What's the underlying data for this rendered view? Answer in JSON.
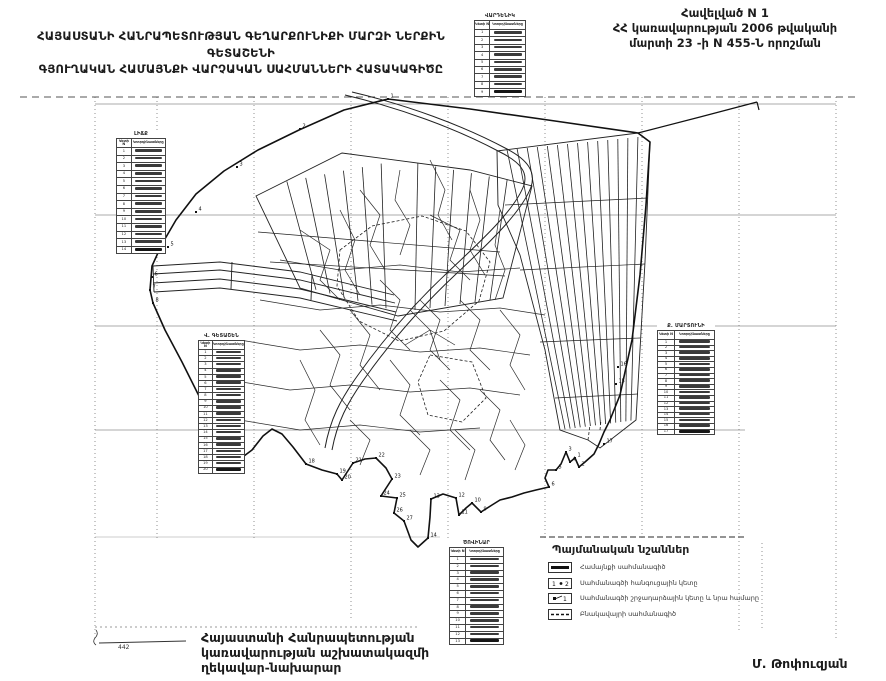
{
  "header": {
    "line1": "Հավելված N 1",
    "line2": "ՀՀ կառավարության 2006 թվականի",
    "line3": "մարտի 23 -ի N 455-Ն որոշման"
  },
  "title": {
    "line1": "ՀԱՅԱՍՏԱՆԻ ՀԱՆՐԱՊԵՏՈՒԹՅԱՆ ԳԵՂԱՐՔՈՒՆԻՔԻ ՄԱՐԶԻ ՆԵՐՔԻՆ ԳԵՏԱՇԵՆԻ",
    "line2": "ԳՅՈՒՂԱԿԱՆ ՀԱՄԱՅՆՔԻ ՎԱՐՉԱԿԱՆ ՍԱՀՄԱՆՆԵՐԻ ՀԱՏԱԿԱԳԻԾԸ"
  },
  "footer": {
    "line1": "Հայաստանի Հանրապետության",
    "line2": "կառավարության աշխատակազմի",
    "line3": "ղեկավար-նախարար",
    "signature": "Մ. Թոփուզյան"
  },
  "legend": {
    "title": "Պայմանական նշաններ",
    "items": [
      {
        "symbol": "community-boundary-line",
        "label": "Համայնքի սահմանագիծ"
      },
      {
        "symbol": "boundary-node-point",
        "label": "Սահմանագծի հանգուցային կետը"
      },
      {
        "symbol": "boundary-turn-point",
        "label": "Սահմանագծի շրջադարձային կետը և նրա համարը"
      },
      {
        "symbol": "settlement-boundary-line",
        "label": "Բնակավայրի սահմանագիծ"
      }
    ]
  },
  "tables": [
    {
      "title": "ՎԱՐԴԵՆԻԿ",
      "col1": "Կետի N",
      "col2": "Կոորդինատները",
      "rows": [
        "1",
        "2",
        "3",
        "4",
        "5",
        "6",
        "7",
        "8",
        "9"
      ]
    },
    {
      "title": "ԼԻՃՔ",
      "col1": "Կետի N",
      "col2": "Կոորդինատները",
      "rows": [
        "1",
        "2",
        "3",
        "4",
        "5",
        "6",
        "7",
        "8",
        "9",
        "10",
        "11",
        "12",
        "13",
        "14"
      ]
    },
    {
      "title": "Վ. ԳԵՏԱՇԵՆ",
      "col1": "Կետի N",
      "col2": "Կոորդինատները",
      "rows": [
        "1",
        "2",
        "3",
        "4",
        "5",
        "6",
        "7",
        "8",
        "9",
        "10",
        "11",
        "12",
        "13",
        "14",
        "15",
        "16",
        "17",
        "18",
        "19",
        "20"
      ]
    },
    {
      "title": "Ք. ՄԱՐՏՈՒՆԻ",
      "col1": "Կետի N",
      "col2": "Կոորդինատները",
      "rows": [
        "1",
        "2",
        "3",
        "4",
        "5",
        "6",
        "7",
        "8",
        "9",
        "10",
        "11",
        "12",
        "13",
        "14",
        "15",
        "16",
        "17"
      ]
    },
    {
      "title": "ԾՈՎԻՆԱՐ",
      "col1": "Կետի N",
      "col2": "Կոորդինատները",
      "rows": [
        "1",
        "2",
        "3",
        "4",
        "5",
        "6",
        "7",
        "8",
        "9",
        "10",
        "11",
        "12",
        "13"
      ]
    }
  ],
  "map": {
    "scale_label": "442",
    "boundary_points": [
      {
        "n": "1",
        "x": 388,
        "y": 99
      },
      {
        "n": "2",
        "x": 300,
        "y": 129
      },
      {
        "n": "3",
        "x": 237,
        "y": 167
      },
      {
        "n": "4",
        "x": 196,
        "y": 212
      },
      {
        "n": "5",
        "x": 168,
        "y": 247
      },
      {
        "n": "6",
        "x": 152,
        "y": 277
      },
      {
        "n": "7",
        "x": 150,
        "y": 290
      },
      {
        "n": "8",
        "x": 153,
        "y": 303
      },
      {
        "n": "9",
        "x": 481,
        "y": 512
      },
      {
        "n": "10",
        "x": 472,
        "y": 503
      },
      {
        "n": "11",
        "x": 459,
        "y": 515
      },
      {
        "n": "12",
        "x": 456,
        "y": 498
      },
      {
        "n": "13",
        "x": 431,
        "y": 499
      },
      {
        "n": "14",
        "x": 428,
        "y": 538
      },
      {
        "n": "15",
        "x": 616,
        "y": 384
      },
      {
        "n": "16",
        "x": 618,
        "y": 367
      },
      {
        "n": "17",
        "x": 604,
        "y": 444
      },
      {
        "n": "18",
        "x": 306,
        "y": 464
      },
      {
        "n": "19",
        "x": 337,
        "y": 474
      },
      {
        "n": "20",
        "x": 342,
        "y": 480
      },
      {
        "n": "21",
        "x": 353,
        "y": 463
      },
      {
        "n": "22",
        "x": 376,
        "y": 458
      },
      {
        "n": "23",
        "x": 392,
        "y": 479
      },
      {
        "n": "24",
        "x": 381,
        "y": 496
      },
      {
        "n": "25",
        "x": 397,
        "y": 498
      },
      {
        "n": "26",
        "x": 394,
        "y": 513
      },
      {
        "n": "27",
        "x": 404,
        "y": 521
      },
      {
        "n": "1",
        "x": 575,
        "y": 458
      },
      {
        "n": "2",
        "x": 579,
        "y": 467
      },
      {
        "n": "3",
        "x": 566,
        "y": 452
      },
      {
        "n": "4",
        "x": 570,
        "y": 462
      },
      {
        "n": "5",
        "x": 556,
        "y": 470
      },
      {
        "n": "6",
        "x": 549,
        "y": 487
      }
    ]
  }
}
